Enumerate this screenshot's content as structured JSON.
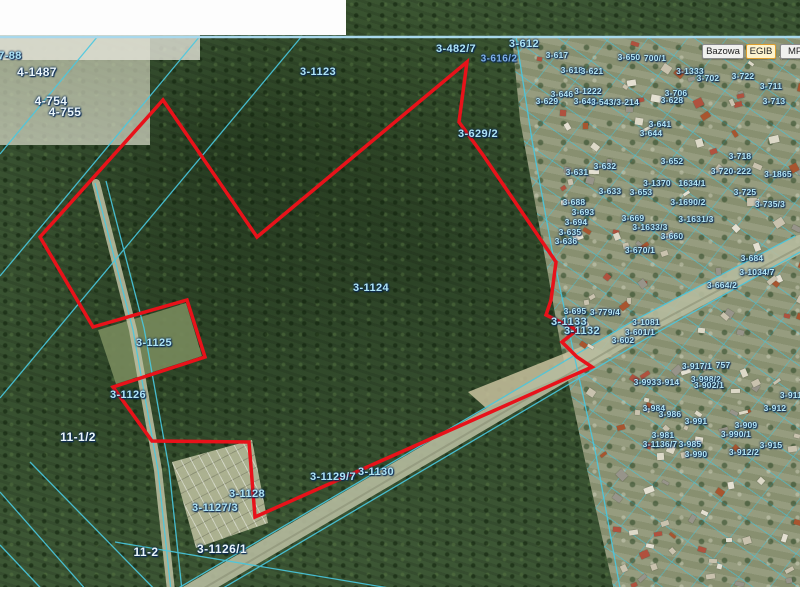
{
  "app": {
    "description": "geoportal cadastral map viewer"
  },
  "toolbar": {
    "buttons": [
      {
        "label": "Bazowa",
        "active": false
      },
      {
        "label": "EGIB",
        "active": true
      },
      {
        "label": "MPZ",
        "active": false,
        "clipped": true
      }
    ]
  },
  "map": {
    "colors": {
      "selection_outline": "#e8121a",
      "cadastral_line": "#49c8e0",
      "label_text_light": "#aee4f6",
      "label_text_white": "#eaf6fc",
      "forest": "#3c5634",
      "urban_ground": "#8f9677"
    },
    "selection_outline": {
      "color": "#e8121a",
      "points": "163,100 257,237 467,62 459,122 483,155 556,262 551,300 546,315 577,330 562,342 577,357 592,367 255,517 249,442 152,441 113,387 205,357 187,300 93,327 40,237"
    },
    "parcel_labels": [
      {
        "t": "7-88",
        "x": 10,
        "y": 56,
        "c": "b"
      },
      {
        "t": "4-1487",
        "x": 37,
        "y": 72,
        "c": "w"
      },
      {
        "t": "4-754",
        "x": 51,
        "y": 101,
        "c": "w"
      },
      {
        "t": "4-755",
        "x": 65,
        "y": 112,
        "c": "w"
      },
      {
        "t": "3-1123",
        "x": 318,
        "y": 72,
        "c": "b"
      },
      {
        "t": "3-1124",
        "x": 371,
        "y": 288,
        "c": "b"
      },
      {
        "t": "3-1125",
        "x": 154,
        "y": 343,
        "c": "b"
      },
      {
        "t": "3-1126",
        "x": 128,
        "y": 395,
        "c": "b"
      },
      {
        "t": "11-1/2",
        "x": 78,
        "y": 437,
        "c": "w"
      },
      {
        "t": "3-1128",
        "x": 247,
        "y": 494,
        "c": "b"
      },
      {
        "t": "3-1127/3",
        "x": 215,
        "y": 508,
        "c": "b"
      },
      {
        "t": "3-1126/1",
        "x": 222,
        "y": 549,
        "c": "w"
      },
      {
        "t": "11-2",
        "x": 146,
        "y": 552,
        "c": "w"
      },
      {
        "t": "3-1129/7",
        "x": 333,
        "y": 477,
        "c": "b"
      },
      {
        "t": "3-1130",
        "x": 376,
        "y": 472,
        "c": "b"
      },
      {
        "t": "3-1133",
        "x": 569,
        "y": 322,
        "c": "b"
      },
      {
        "t": "3-1132",
        "x": 582,
        "y": 331,
        "c": "b"
      },
      {
        "t": "3-629/2",
        "x": 478,
        "y": 134,
        "c": "b"
      },
      {
        "t": "3-482/7",
        "x": 456,
        "y": 49,
        "c": "b"
      },
      {
        "t": "3-612",
        "x": 524,
        "y": 44,
        "c": "b"
      },
      {
        "t": "3-616/2",
        "x": 499,
        "y": 59,
        "c": "d"
      },
      {
        "t": "3-617",
        "x": 557,
        "y": 55,
        "c": "s"
      },
      {
        "t": "3-618",
        "x": 572,
        "y": 70,
        "c": "s"
      },
      {
        "t": "3-621",
        "x": 592,
        "y": 71,
        "c": "s"
      },
      {
        "t": "3-650",
        "x": 629,
        "y": 57,
        "c": "s"
      },
      {
        "t": "700/1",
        "x": 655,
        "y": 58,
        "c": "s"
      },
      {
        "t": "3-1333",
        "x": 690,
        "y": 71,
        "c": "s"
      },
      {
        "t": "3-702",
        "x": 708,
        "y": 78,
        "c": "s"
      },
      {
        "t": "3-722",
        "x": 743,
        "y": 76,
        "c": "s"
      },
      {
        "t": "3-711",
        "x": 771,
        "y": 86,
        "c": "s"
      },
      {
        "t": "3-706",
        "x": 676,
        "y": 93,
        "c": "s"
      },
      {
        "t": "3-628",
        "x": 672,
        "y": 100,
        "c": "s"
      },
      {
        "t": "3-713",
        "x": 774,
        "y": 101,
        "c": "s"
      },
      {
        "t": "3-646",
        "x": 562,
        "y": 94,
        "c": "s"
      },
      {
        "t": "3-640",
        "x": 585,
        "y": 101,
        "c": "s"
      },
      {
        "t": "3-629",
        "x": 547,
        "y": 101,
        "c": "s"
      },
      {
        "t": "3-1222",
        "x": 588,
        "y": 91,
        "c": "s"
      },
      {
        "t": "3-543/3-214",
        "x": 615,
        "y": 102,
        "c": "s"
      },
      {
        "t": "3-641",
        "x": 660,
        "y": 124,
        "c": "s"
      },
      {
        "t": "3-644",
        "x": 651,
        "y": 133,
        "c": "s"
      },
      {
        "t": "3-631",
        "x": 577,
        "y": 172,
        "c": "s"
      },
      {
        "t": "3-632",
        "x": 605,
        "y": 166,
        "c": "s"
      },
      {
        "t": "3-652",
        "x": 672,
        "y": 161,
        "c": "s"
      },
      {
        "t": "3-718",
        "x": 740,
        "y": 156,
        "c": "s"
      },
      {
        "t": "3-720-222",
        "x": 731,
        "y": 171,
        "c": "s"
      },
      {
        "t": "3-1865",
        "x": 778,
        "y": 174,
        "c": "s"
      },
      {
        "t": "3-1370",
        "x": 657,
        "y": 183,
        "c": "s"
      },
      {
        "t": "1634/1",
        "x": 692,
        "y": 183,
        "c": "s"
      },
      {
        "t": "3-653",
        "x": 641,
        "y": 192,
        "c": "s"
      },
      {
        "t": "3-633",
        "x": 610,
        "y": 191,
        "c": "s"
      },
      {
        "t": "3-725",
        "x": 745,
        "y": 192,
        "c": "s"
      },
      {
        "t": "3-1690/2",
        "x": 688,
        "y": 202,
        "c": "s"
      },
      {
        "t": "3-735/3",
        "x": 770,
        "y": 204,
        "c": "s"
      },
      {
        "t": "3-688",
        "x": 574,
        "y": 202,
        "c": "s"
      },
      {
        "t": "3-693",
        "x": 583,
        "y": 212,
        "c": "s"
      },
      {
        "t": "3-694",
        "x": 576,
        "y": 222,
        "c": "s"
      },
      {
        "t": "3-669",
        "x": 633,
        "y": 218,
        "c": "s"
      },
      {
        "t": "3-1631/3",
        "x": 696,
        "y": 219,
        "c": "s"
      },
      {
        "t": "3-1633/3",
        "x": 650,
        "y": 227,
        "c": "s"
      },
      {
        "t": "3-660",
        "x": 672,
        "y": 236,
        "c": "s"
      },
      {
        "t": "3-670/1",
        "x": 640,
        "y": 250,
        "c": "s"
      },
      {
        "t": "3-635",
        "x": 570,
        "y": 232,
        "c": "s"
      },
      {
        "t": "3-636",
        "x": 566,
        "y": 241,
        "c": "s"
      },
      {
        "t": "3-684",
        "x": 752,
        "y": 258,
        "c": "s"
      },
      {
        "t": "3-1034/7",
        "x": 757,
        "y": 272,
        "c": "s"
      },
      {
        "t": "3-664/2",
        "x": 722,
        "y": 285,
        "c": "s"
      },
      {
        "t": "3-695",
        "x": 575,
        "y": 311,
        "c": "s"
      },
      {
        "t": "3-779/4",
        "x": 605,
        "y": 312,
        "c": "s"
      },
      {
        "t": "3-1081",
        "x": 646,
        "y": 322,
        "c": "s"
      },
      {
        "t": "3-601/1",
        "x": 640,
        "y": 332,
        "c": "s"
      },
      {
        "t": "3-602",
        "x": 623,
        "y": 340,
        "c": "s"
      },
      {
        "t": "3-917/1",
        "x": 697,
        "y": 366,
        "c": "s"
      },
      {
        "t": "757",
        "x": 723,
        "y": 365,
        "c": "s"
      },
      {
        "t": "3-993",
        "x": 645,
        "y": 382,
        "c": "s"
      },
      {
        "t": "3-914",
        "x": 668,
        "y": 382,
        "c": "s"
      },
      {
        "t": "3-998/2",
        "x": 706,
        "y": 379,
        "c": "s"
      },
      {
        "t": "3-902/1",
        "x": 709,
        "y": 385,
        "c": "s"
      },
      {
        "t": "3-911",
        "x": 791,
        "y": 395,
        "c": "s"
      },
      {
        "t": "3-984",
        "x": 654,
        "y": 408,
        "c": "s"
      },
      {
        "t": "3-912",
        "x": 775,
        "y": 408,
        "c": "s"
      },
      {
        "t": "3-986",
        "x": 670,
        "y": 414,
        "c": "s"
      },
      {
        "t": "3-991",
        "x": 696,
        "y": 421,
        "c": "s"
      },
      {
        "t": "3-909",
        "x": 746,
        "y": 425,
        "c": "s"
      },
      {
        "t": "3-990/1",
        "x": 736,
        "y": 434,
        "c": "s"
      },
      {
        "t": "3-981",
        "x": 663,
        "y": 435,
        "c": "s"
      },
      {
        "t": "3-1136/7",
        "x": 660,
        "y": 444,
        "c": "s"
      },
      {
        "t": "3-985",
        "x": 690,
        "y": 444,
        "c": "s"
      },
      {
        "t": "3-915",
        "x": 771,
        "y": 445,
        "c": "s"
      },
      {
        "t": "3-912/2",
        "x": 744,
        "y": 452,
        "c": "s"
      },
      {
        "t": "3-990",
        "x": 696,
        "y": 454,
        "c": "s"
      }
    ]
  }
}
